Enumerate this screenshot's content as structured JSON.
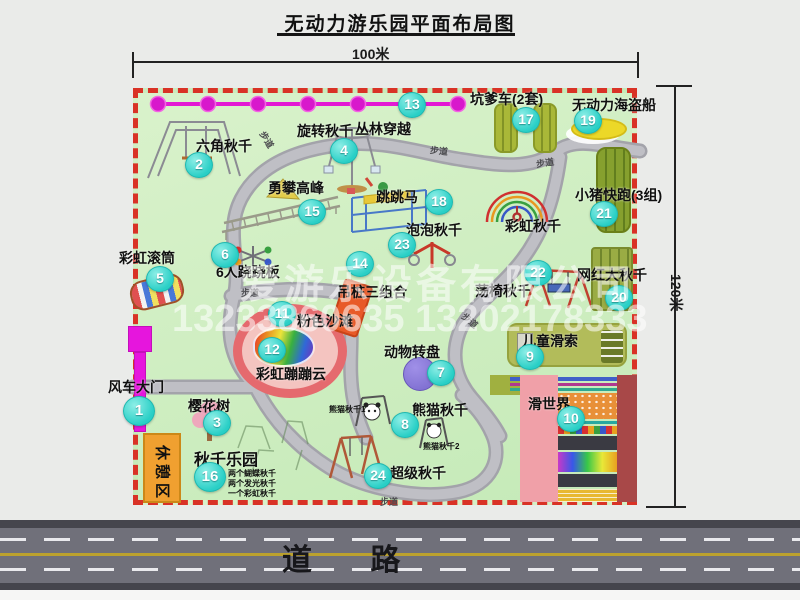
{
  "title": "无动力游乐园平面布局图",
  "dimensions": {
    "horizontal": "100米",
    "vertical": "120米"
  },
  "road_label": "道 路",
  "path_label": "步道",
  "rest_area_label": "休憩区",
  "watermark": {
    "company": "爱游乐设备有限公司",
    "phone": "13233860635 13202178333"
  },
  "attractions": {
    "a1": {
      "num": "1",
      "label": "风车大门"
    },
    "a2": {
      "num": "2",
      "label": "六角秋千"
    },
    "a3": {
      "num": "3",
      "label": "樱花树"
    },
    "a4": {
      "num": "4",
      "label": "旋转秋千"
    },
    "a5": {
      "num": "5",
      "label": "彩虹滚筒"
    },
    "a6": {
      "num": "6",
      "label": "6人跷跷板"
    },
    "a7": {
      "num": "7",
      "label": "动物转盘"
    },
    "a8": {
      "num": "8",
      "label": "熊猫秋千",
      "sub1": "熊猫秋千1",
      "sub2": "熊猫秋千2"
    },
    "a9": {
      "num": "9",
      "label": "儿童滑索"
    },
    "a10": {
      "num": "10",
      "label": "滑世界"
    },
    "a11": {
      "num": "11",
      "label": "粉色沙滩"
    },
    "a12": {
      "num": "12",
      "label": "彩虹蹦蹦云"
    },
    "a13": {
      "num": "13",
      "label": "丛林穿越"
    },
    "a14": {
      "num": "14",
      "label": "吊桩三组合"
    },
    "a15": {
      "num": "15",
      "label": "勇攀高峰"
    },
    "a16": {
      "num": "16",
      "label": "秋千乐园",
      "sub1": "两个蝴蝶秋千",
      "sub2": "两个发光秋千",
      "sub3": "一个彩虹秋千"
    },
    "a17": {
      "num": "17",
      "label": "坑爹车(2套)"
    },
    "a18": {
      "num": "18",
      "label": "跳跳马"
    },
    "a19": {
      "num": "19",
      "label": "无动力海盗船"
    },
    "a20": {
      "num": "20",
      "label": "网红大秋千"
    },
    "a21": {
      "num": "21",
      "label": "小猪快跑(3组)"
    },
    "a22": {
      "num": "22",
      "label": "荡椅秋千"
    },
    "a23": {
      "num": "23",
      "label": "泡泡秋千"
    },
    "a24": {
      "num": "24",
      "label": "超级秋千"
    },
    "rainbow_swing": {
      "label": "彩虹秋千"
    }
  }
}
